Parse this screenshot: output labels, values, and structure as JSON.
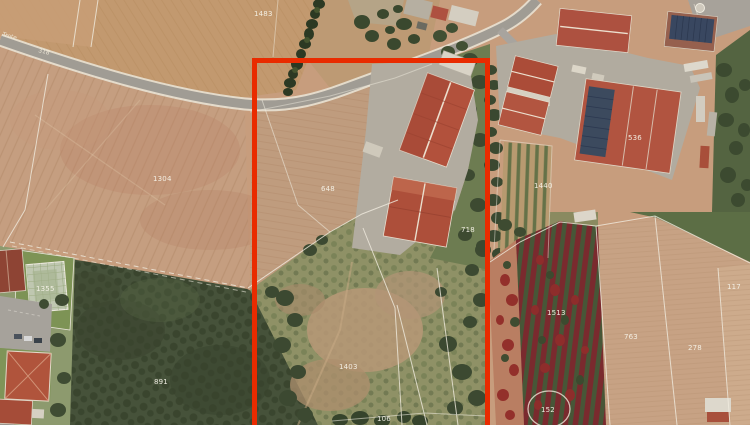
{
  "map": {
    "type": "aerial-cadastral-photo",
    "highlight": {
      "shape": "rectangle-open-bottom",
      "color": "#e92b00"
    },
    "parcel_labels": [
      {
        "id": "1483",
        "text": "1483"
      },
      {
        "id": "1304",
        "text": "1304"
      },
      {
        "id": "648",
        "text": "648"
      },
      {
        "id": "536",
        "text": "536"
      },
      {
        "id": "1440",
        "text": "1440"
      },
      {
        "id": "718",
        "text": "718"
      },
      {
        "id": "1355",
        "text": "1355"
      },
      {
        "id": "891",
        "text": "891"
      },
      {
        "id": "1403",
        "text": "1403"
      },
      {
        "id": "106",
        "text": "106"
      },
      {
        "id": "1513",
        "text": "1513"
      },
      {
        "id": "763",
        "text": "763"
      },
      {
        "id": "278",
        "text": "278"
      },
      {
        "id": "117",
        "text": "117"
      },
      {
        "id": "152",
        "text": "152"
      }
    ],
    "road_labels": [
      {
        "text": "Trote"
      },
      {
        "text": "318"
      }
    ],
    "colors": {
      "field_tan": "#c79d7d",
      "forest_green": "#46523a",
      "scrub_green": "#8f9166",
      "roof_terracotta": "#b2513c",
      "road_gray": "#a09c94",
      "solar_blue": "#394760",
      "vineyard_red": "#7a2a2e",
      "boundary_line": "#f0ecdf",
      "label_text": "#f6f3e8",
      "highlight_red": "#e92b00"
    }
  }
}
